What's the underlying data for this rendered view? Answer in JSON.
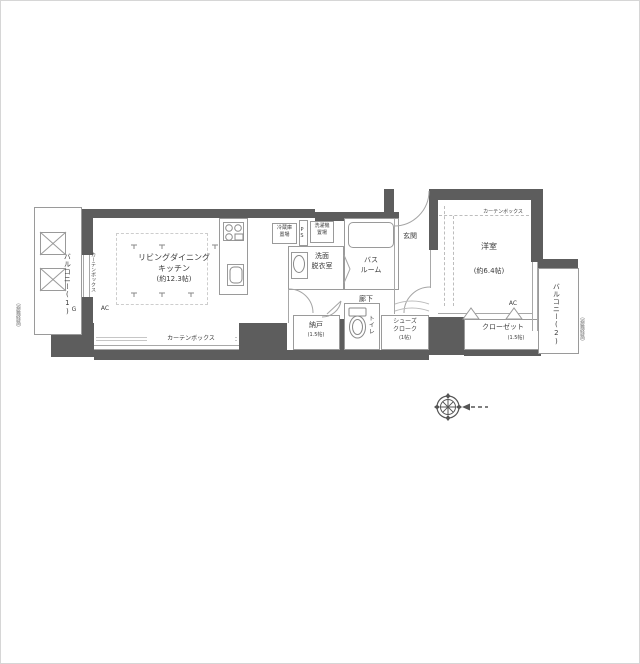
{
  "plan": {
    "rooms": {
      "ldk": {
        "name_line1": "リビングダイニング",
        "name_line2": "キッチン",
        "size": "(約12.3帖)"
      },
      "western_room": {
        "name": "洋室",
        "size": "(約6.4帖)"
      },
      "bathroom": {
        "line1": "バス",
        "line2": "ルーム"
      },
      "washroom": {
        "line1": "洗面",
        "line2": "脱衣室"
      },
      "hallway": "廊下",
      "entrance": "玄関",
      "storage_room": {
        "name": "納戸",
        "size": "(1.5帖)"
      },
      "toilet": "トイレ",
      "shoe_closet": {
        "line1": "シューズ",
        "line2": "クローク",
        "size": "(1帖)"
      },
      "closet": {
        "name": "クローゼット",
        "size": "(1.5帖)"
      },
      "balcony1": "バルコニー(1)",
      "balcony2": "バルコニー(2)"
    },
    "equipment": {
      "refrigerator_line1": "冷蔵庫",
      "refrigerator_line2": "置場",
      "washer_line1": "洗濯機",
      "washer_line2": "置場",
      "pipe_space": "PS",
      "curtain_box": "カーテンボックス",
      "curtain_box_vertical": "カーテンボックス",
      "curtain_box_west": "カーテンボックス",
      "ac_ldk": "AC",
      "ac_west": "AC",
      "gas_meter": "G",
      "escape_route_left": "（避難経路）",
      "escape_route_right": "（避難経路）"
    },
    "colors": {
      "wall": "#5d5d5d",
      "line": "#9a9a9a",
      "text": "#3c3c3c",
      "background": "#ffffff"
    }
  }
}
